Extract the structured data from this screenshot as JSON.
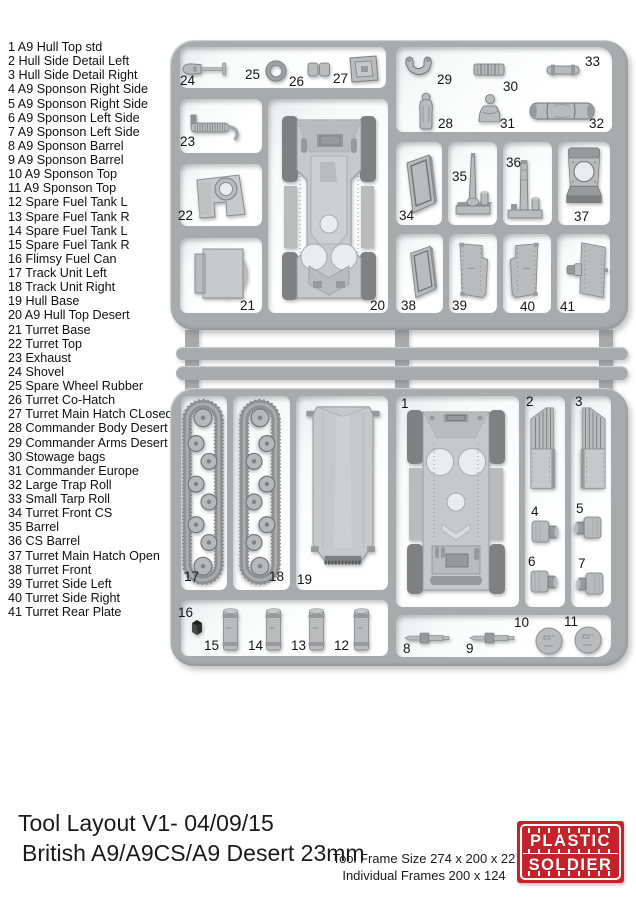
{
  "parts_list": {
    "items": [
      "1 A9 Hull Top std",
      "2 Hull Side Detail Left",
      "3 Hull Side Detail Right",
      "4 A9 Sponson Right Side",
      "5 A9 Sponson Right Side",
      "6 A9 Sponson Left Side",
      "7 A9 Sponson Left Side",
      "8 A9 Sponson Barrel",
      "9 A9 Sponson Barrel",
      "10 A9 Sponson Top",
      "11 A9 Sponson Top",
      "12 Spare Fuel Tank L",
      "13 Spare Fuel Tank R",
      "14 Spare Fuel Tank L",
      "15 Spare Fuel Tank R",
      "16 Flimsy Fuel Can",
      "17 Track Unit Left",
      "18 Track Unit Right",
      "19 Hull Base",
      "20 A9 Hull Top Desert",
      "21 Turret Base",
      "22 Turret Top",
      "23 Exhaust",
      "24 Shovel",
      "25 Spare Wheel Rubber",
      "26 Turret Co-Hatch",
      "27 Turret Main Hatch CLosed",
      "28 Commander Body Desert",
      "29 Commander Arms Desert",
      "30 Stowage bags",
      "31 Commander Europe",
      "32 Large Trap Roll",
      "33 Small Tarp Roll",
      "34 Turret Front CS",
      "35 Barrel",
      "36 CS Barrel",
      "37 Turret Main Hatch Open",
      "38 Turret Front",
      "39 Turret Side Left",
      "40 Turret Side Right",
      "41 Turret Rear Plate"
    ]
  },
  "sprue": {
    "nums": {
      "1": "1",
      "2": "2",
      "3": "3",
      "4": "4",
      "5": "5",
      "6": "6",
      "7": "7",
      "8": "8",
      "9": "9",
      "10": "10",
      "11": "11",
      "12": "12",
      "13": "13",
      "14": "14",
      "15": "15",
      "16": "16",
      "17": "17",
      "18": "18",
      "19": "19",
      "20": "20",
      "21": "21",
      "22": "22",
      "23": "23",
      "24": "24",
      "25": "25",
      "26": "26",
      "27": "27",
      "28": "28",
      "29": "29",
      "30": "30",
      "31": "31",
      "32": "32",
      "33": "33",
      "34": "34",
      "35": "35",
      "36": "36",
      "37": "37",
      "38": "38",
      "39": "39",
      "40": "40",
      "41": "41"
    }
  },
  "footer": {
    "line1": "Tool Layout V1- 04/09/15",
    "line2": "British A9/A9CS/A9 Desert 23mm",
    "frame_size": "Tool Frame Size 274 x 200 x 22",
    "individual_frames": "Individual Frames 200 x 124",
    "logo": {
      "word1": "PLASTIC",
      "word2": "SOLDIER",
      "bg_color": "#c7222a"
    }
  }
}
